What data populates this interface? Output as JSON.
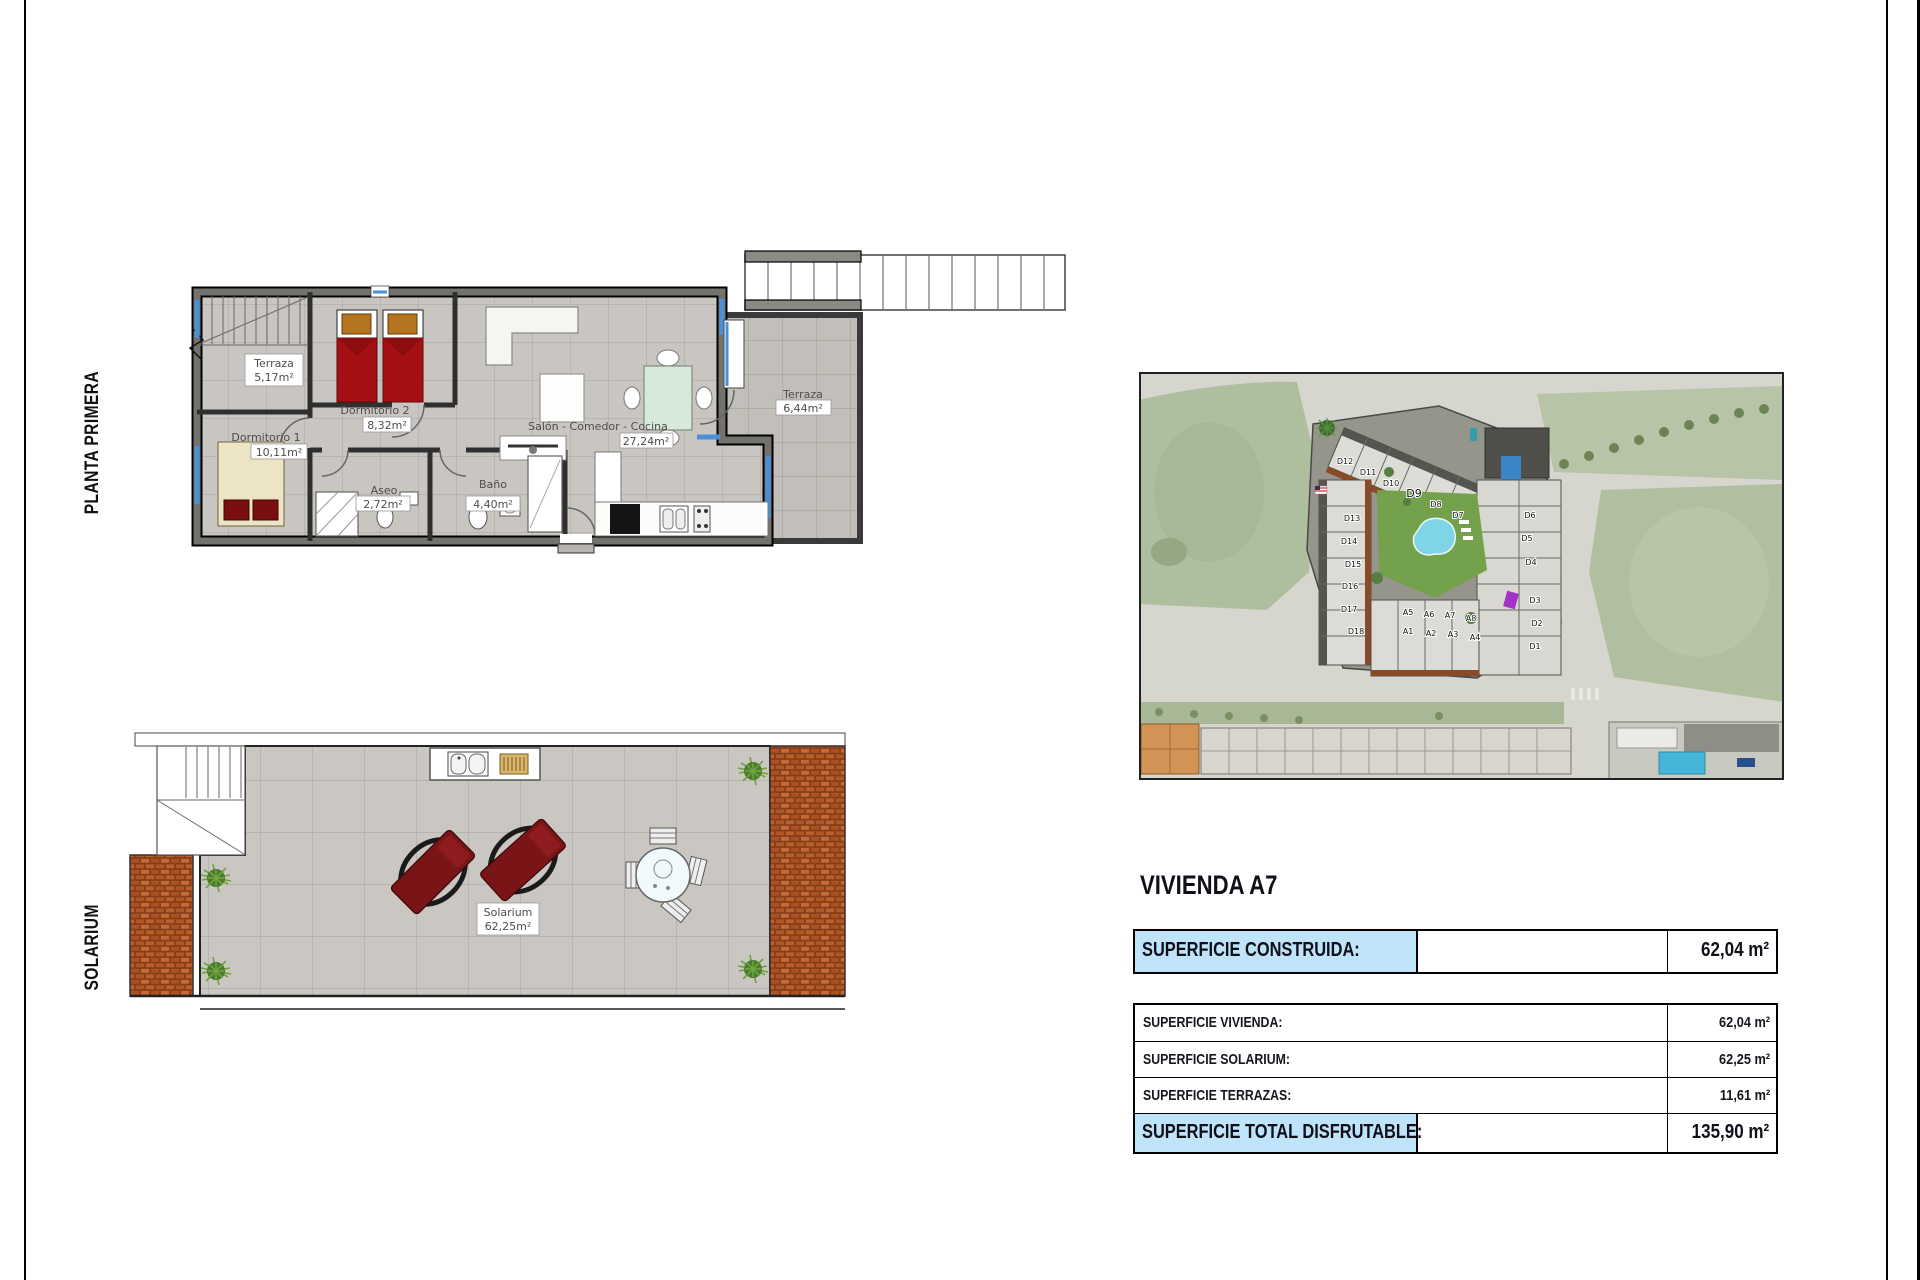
{
  "side_labels": {
    "plan1": "PLANTA PRIMERA",
    "plan2": "SOLARIUM"
  },
  "plan1": {
    "rooms": [
      {
        "name": "Terraza",
        "area": "5,17m²"
      },
      {
        "name": "Dormitorio 2",
        "area": "8,32m²"
      },
      {
        "name": "Dormitorio 1",
        "area": "10,11m²"
      },
      {
        "name": "Aseo",
        "area": "2,72m²"
      },
      {
        "name": "Baño",
        "area": "4,40m²"
      },
      {
        "name": "Salón - Comedor - Cocina",
        "area": "27,24m²"
      },
      {
        "name": "Terraza",
        "area": "6,44m²"
      }
    ]
  },
  "plan2": {
    "room": {
      "name": "Solarium",
      "area": "62,25m²"
    }
  },
  "site_map": {
    "units": [
      "D12",
      "D11",
      "D10",
      "D9",
      "D8",
      "D7",
      "D13",
      "D14",
      "D15",
      "D16",
      "D17",
      "D18",
      "D6",
      "D5",
      "D4",
      "D3",
      "D2",
      "D1",
      "A5",
      "A6",
      "A7",
      "A8",
      "A1",
      "A2",
      "A3",
      "A4"
    ]
  },
  "panel": {
    "title": "VIVIENDA A7",
    "main_row": {
      "label": "SUPERFICIE CONSTRUIDA:",
      "value": "62,04 m²"
    },
    "rows": [
      {
        "label": "SUPERFICIE VIVIENDA:",
        "value": "62,04 m²"
      },
      {
        "label": "SUPERFICIE SOLARIUM:",
        "value": "62,25 m²"
      },
      {
        "label": "SUPERFICIE TERRAZAS:",
        "value": "11,61 m²"
      }
    ],
    "total_row": {
      "label": "SUPERFICIE TOTAL DISFRUTABLE:",
      "value": "135,90 m²"
    }
  },
  "colors": {
    "highlight_blue": "#bfe3f8",
    "roof_tile_orange": "#b85c28",
    "bed_red": "#a51015",
    "pool_blue": "#7dd5e6",
    "courtyard_green": "#74a14b",
    "floor_gray": "#c9c6c1",
    "window_blue": "#4a90d9"
  }
}
